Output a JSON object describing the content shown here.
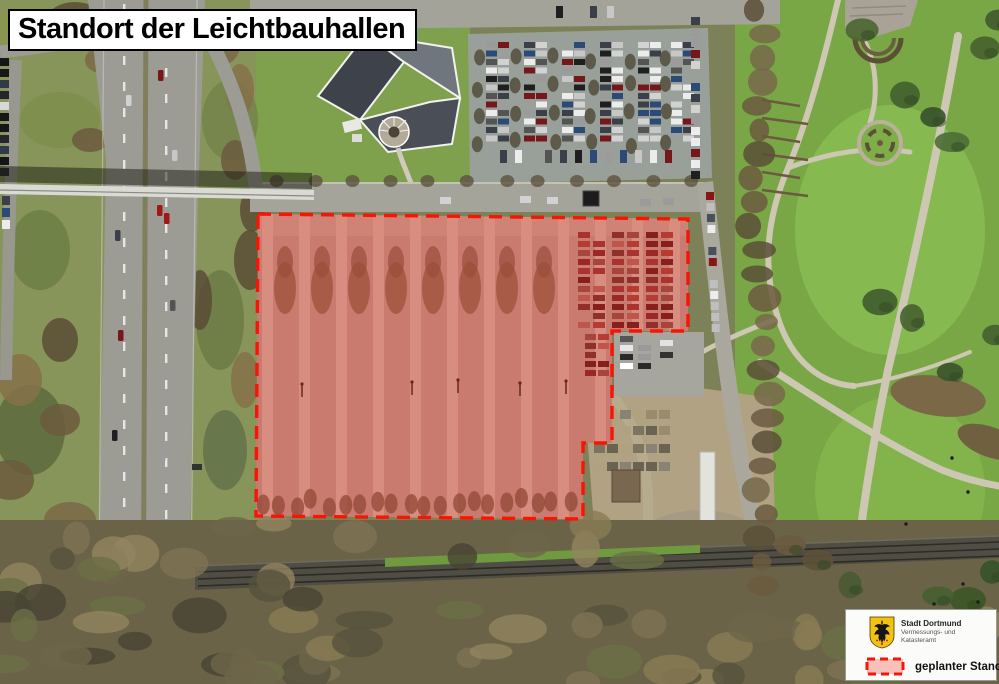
{
  "title": "Standort der Leichtbauhallen",
  "legend": {
    "org_name": "Stadt Dortmund",
    "org_dept_line1": "Vermessungs- und",
    "org_dept_line2": "Katasteramt",
    "item_label": "geplanter Standort"
  },
  "colors": {
    "highlight_red": "#f71505",
    "highlight_fill": "rgba(228,60,45,0.30)",
    "swatch_fill": "#f7c0b8",
    "crest_gold": "#f3c211",
    "title_text": "#000000",
    "legend_bg": "#fbfbfa"
  }
}
